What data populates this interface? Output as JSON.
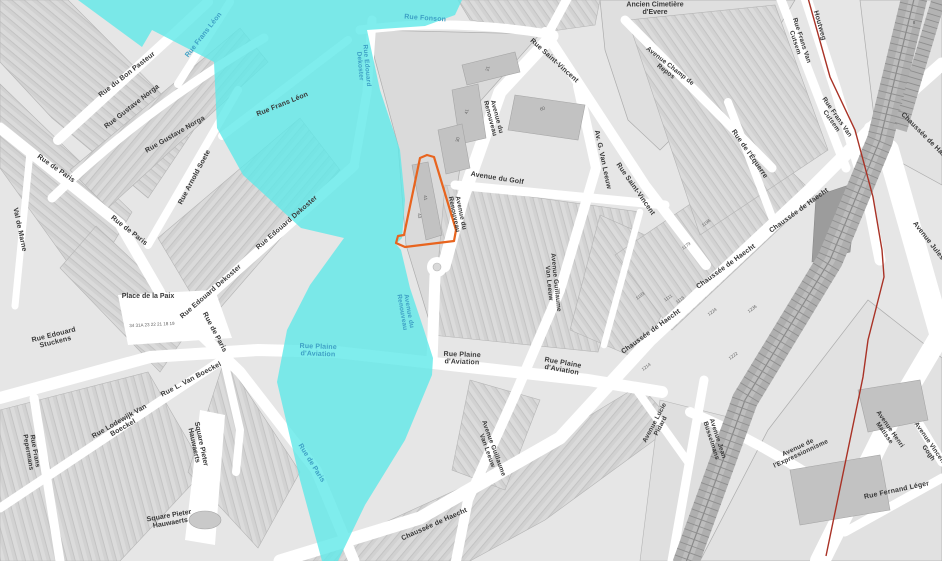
{
  "map": {
    "colors": {
      "flood_zone": "#5FE8E8",
      "parcel_outline": "#E8641E",
      "municipal_boundary": "#A93226",
      "road": "#FFFFFF",
      "building": "#C2C2C2",
      "railway_band": "#AFAFAF",
      "label_black": "#383838",
      "label_blue": "#3D9FC4"
    }
  },
  "street_labels": [
    {
      "t": "Rue du Bon Pasteur",
      "x": 128,
      "y": 76,
      "r": -38
    },
    {
      "t": "Rue Frans Léon",
      "x": 205,
      "y": 36,
      "r": -52,
      "c": "blue"
    },
    {
      "t": "Rue Frans Léon",
      "x": 283,
      "y": 106,
      "r": -22
    },
    {
      "t": "Rue Fonson",
      "x": 425,
      "y": 20,
      "r": 4,
      "c": "blue"
    },
    {
      "t": "Rue Edouard\nDekoster",
      "x": 362,
      "y": 66,
      "r": 85,
      "c": "blue",
      "s": 6.5
    },
    {
      "t": "Rue Gustave Norga",
      "x": 133,
      "y": 108,
      "r": -38
    },
    {
      "t": "Rue Gustave Norga",
      "x": 176,
      "y": 136,
      "r": -30
    },
    {
      "t": "Rue Arnold Soete",
      "x": 196,
      "y": 178,
      "r": -62
    },
    {
      "t": "Val de Marne",
      "x": 18,
      "y": 230,
      "r": 78
    },
    {
      "t": "Rue de Paris",
      "x": 55,
      "y": 170,
      "r": 35
    },
    {
      "t": "Rue de Paris",
      "x": 128,
      "y": 232,
      "r": 38
    },
    {
      "t": "Rue de Paris",
      "x": 213,
      "y": 333,
      "r": 62
    },
    {
      "t": "Rue de Paris",
      "x": 310,
      "y": 464,
      "r": 58,
      "c": "blue"
    },
    {
      "t": "Rue Edouard\nStuckens",
      "x": 55,
      "y": 340,
      "r": -14
    },
    {
      "t": "Rue Edouard Dekoster",
      "x": 212,
      "y": 293,
      "r": -41
    },
    {
      "t": "Rue Edouard Dekoster",
      "x": 288,
      "y": 224,
      "r": -41
    },
    {
      "t": "Rue Frans\nPepermans",
      "x": 30,
      "y": 452,
      "r": 80,
      "s": 6.5
    },
    {
      "t": "Rue Lodewijk Van\nBoeckel",
      "x": 122,
      "y": 426,
      "r": -30
    },
    {
      "t": "Rue L. Van Boeckel",
      "x": 192,
      "y": 381,
      "r": -28
    },
    {
      "t": "Rue Plaine\nd'Aviation",
      "x": 318,
      "y": 352,
      "r": 2,
      "c": "blue"
    },
    {
      "t": "Rue Plaine\nd'Aviation",
      "x": 462,
      "y": 360,
      "r": 2
    },
    {
      "t": "Rue Plaine\nd'Aviation",
      "x": 562,
      "y": 368,
      "r": 10
    },
    {
      "t": "Avenue du\nRenouveau",
      "x": 492,
      "y": 118,
      "r": 75,
      "s": 6.5
    },
    {
      "t": "Avenue du\nRenouveau",
      "x": 456,
      "y": 214,
      "r": 78,
      "s": 6.5
    },
    {
      "t": "Avenue du\nRenouveau",
      "x": 404,
      "y": 312,
      "r": 80,
      "c": "blue",
      "s": 6.5
    },
    {
      "t": "Avenue du Golf",
      "x": 497,
      "y": 180,
      "r": 9
    },
    {
      "t": "Av. G. Van Leeuw",
      "x": 601,
      "y": 160,
      "r": 78
    },
    {
      "t": "Rue Saint-Vincent",
      "x": 553,
      "y": 62,
      "r": 42
    },
    {
      "t": "Rue Saint-Vincent",
      "x": 634,
      "y": 190,
      "r": 55
    },
    {
      "t": "Avenue Guillaume\nVan Leeuw",
      "x": 551,
      "y": 283,
      "r": 84,
      "s": 6.5
    },
    {
      "t": "Avenue Guillaume\nVan Leeuw",
      "x": 489,
      "y": 450,
      "r": 70,
      "s": 6.5
    },
    {
      "t": "Rue de l'Équerre",
      "x": 748,
      "y": 155,
      "r": 55
    },
    {
      "t": "Avenue Champ de\nRepos",
      "x": 667,
      "y": 70,
      "r": 38,
      "s": 6.5
    },
    {
      "t": "Rue Frans Van\nCutsem",
      "x": 797,
      "y": 42,
      "r": 72,
      "s": 6.5
    },
    {
      "t": "Rue Frans Van\nCutsem",
      "x": 833,
      "y": 120,
      "r": 55,
      "s": 6.5
    },
    {
      "t": "Houtweg",
      "x": 818,
      "y": 26,
      "r": 74
    },
    {
      "t": "Chaussée de Haecht",
      "x": 652,
      "y": 333,
      "r": -36
    },
    {
      "t": "Chaussée de Haecht",
      "x": 727,
      "y": 268,
      "r": -36
    },
    {
      "t": "Chaussée de Haecht",
      "x": 800,
      "y": 212,
      "r": -36
    },
    {
      "t": "Chaussée de Haecht",
      "x": 926,
      "y": 140,
      "r": 45
    },
    {
      "t": "Chaussée de Haecht",
      "x": 435,
      "y": 526,
      "r": -24
    },
    {
      "t": "Avenue Jules Bordet",
      "x": 935,
      "y": 252,
      "r": 52
    },
    {
      "t": "Avenue Lucie\nPidard",
      "x": 659,
      "y": 425,
      "r": -62,
      "s": 6.5
    },
    {
      "t": "Avenue Jean\nBusselmans",
      "x": 713,
      "y": 440,
      "r": 72,
      "s": 6.5
    },
    {
      "t": "Avenue de\nl'Expressionnisme",
      "x": 800,
      "y": 452,
      "r": -25,
      "s": 6.5
    },
    {
      "t": "Avenue Henri\nMatisse",
      "x": 886,
      "y": 432,
      "r": 55,
      "s": 6.5
    },
    {
      "t": "Avenue Vincent Van\nGogh",
      "x": 930,
      "y": 452,
      "r": 55,
      "s": 6.5
    },
    {
      "t": "Rue Fernand Léger",
      "x": 897,
      "y": 492,
      "r": -12
    }
  ],
  "place_labels": [
    {
      "t": "Place de la Paix",
      "x": 148,
      "y": 298,
      "r": 0
    },
    {
      "t": "Ancien Cimetière\nd'Evere",
      "x": 655,
      "y": 10,
      "r": 0
    },
    {
      "t": "Square Pieter\nHauwaerts",
      "x": 196,
      "y": 445,
      "r": 78
    },
    {
      "t": "Square Pieter\nHauwaerts",
      "x": 170,
      "y": 521,
      "r": -10
    }
  ],
  "house_numbers": [
    {
      "t": "34 31A 23 22 21 18 19",
      "x": 152,
      "y": 326,
      "r": -3
    },
    {
      "t": "1103",
      "x": 641,
      "y": 297,
      "r": -36
    },
    {
      "t": "1111",
      "x": 669,
      "y": 299,
      "r": -36
    },
    {
      "t": "1115",
      "x": 681,
      "y": 301,
      "r": -36
    },
    {
      "t": "1179",
      "x": 687,
      "y": 247,
      "r": -36
    },
    {
      "t": "1196",
      "x": 707,
      "y": 224,
      "r": -36
    },
    {
      "t": "1224",
      "x": 713,
      "y": 313,
      "r": -36
    },
    {
      "t": "1236",
      "x": 753,
      "y": 310,
      "r": -36
    },
    {
      "t": "1222",
      "x": 734,
      "y": 357,
      "r": -36
    },
    {
      "t": "1214",
      "x": 647,
      "y": 368,
      "r": -36
    }
  ],
  "building_numbers": [
    {
      "t": "21",
      "x": 489,
      "y": 69,
      "r": -75
    },
    {
      "t": "41",
      "x": 468,
      "y": 112,
      "r": -75
    },
    {
      "t": "30",
      "x": 459,
      "y": 140,
      "r": -75
    },
    {
      "t": "60",
      "x": 543,
      "y": 110,
      "r": -20
    },
    {
      "t": "41",
      "x": 424,
      "y": 198,
      "r": 80
    },
    {
      "t": "43",
      "x": 418,
      "y": 216,
      "r": 80
    },
    {
      "t": "8",
      "x": 914,
      "y": 24,
      "r": 0
    }
  ]
}
